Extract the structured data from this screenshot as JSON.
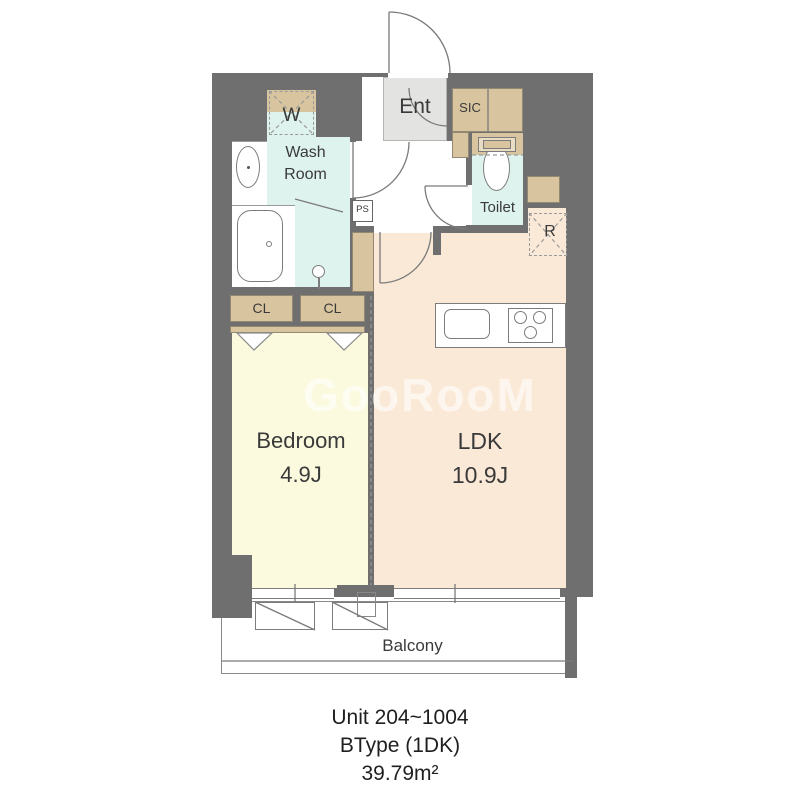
{
  "floorplan": {
    "watermark": "GooRooM",
    "rooms": {
      "ent": {
        "label": "Ent"
      },
      "sic": {
        "label": "SIC"
      },
      "washer": {
        "label": "W"
      },
      "washroom": {
        "label_line1": "Wash",
        "label_line2": "Room"
      },
      "toilet": {
        "label": "Toilet"
      },
      "ps": {
        "label": "PS"
      },
      "fridge": {
        "label": "R"
      },
      "closet_left": {
        "label": "CL"
      },
      "closet_right": {
        "label": "CL"
      },
      "bedroom": {
        "label": "Bedroom",
        "size": "4.9J"
      },
      "ldk": {
        "label": "LDK",
        "size": "10.9J"
      },
      "balcony": {
        "label": "Balcony"
      }
    },
    "caption": {
      "line1": "Unit 204~1004",
      "line2": "BType (1DK)",
      "line3": "39.79m²"
    },
    "colors": {
      "wall": "#6f6f6f",
      "wet_area": "#def3ed",
      "storage": "#d8c5a0",
      "bedroom_floor": "#fbfadf",
      "ldk_floor": "#fbe9d8",
      "entrance_floor": "#e3e3e2"
    }
  }
}
